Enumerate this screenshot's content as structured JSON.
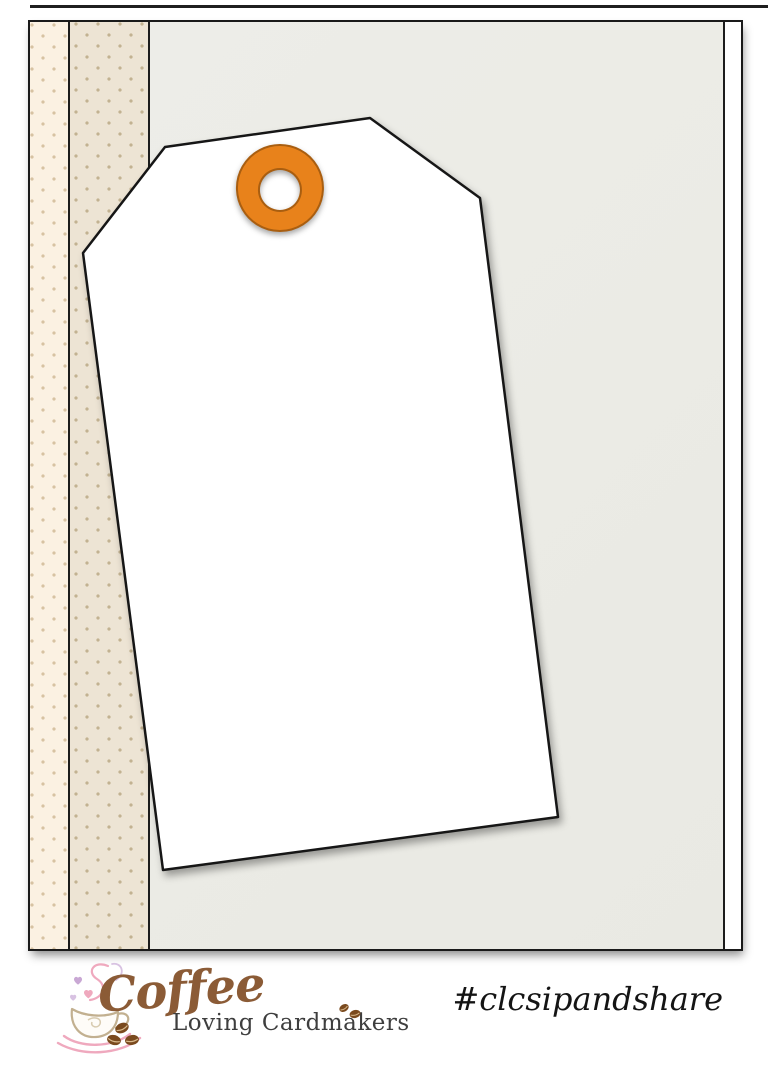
{
  "branding": {
    "logo_script": "Coffee",
    "logo_subtitle": "Loving Cardmakers",
    "hashtag": "#clcsipandshare"
  },
  "icons": {
    "coffee_cup": "coffee-cup line-art with heart steam",
    "coffee_beans": "brown coffee beans",
    "grommet": "orange tag grommet ring"
  },
  "colors": {
    "grommet_orange": "#E8821B",
    "grommet_rim": "#A95E10",
    "strip_cream": "#FBF1E2",
    "strip_tan": "#EDE4D4",
    "panel_gray": "#EBEBE6",
    "outline_dark": "#1A1A1A",
    "tag_white": "#FFFFFF",
    "logo_brown": "#8B5B36",
    "logo_text_gray": "#3E3E3E",
    "steam_pink": "#EFA9BE",
    "heart_lavender": "#C9A8D4",
    "bean_brown": "#7A4A1E"
  }
}
